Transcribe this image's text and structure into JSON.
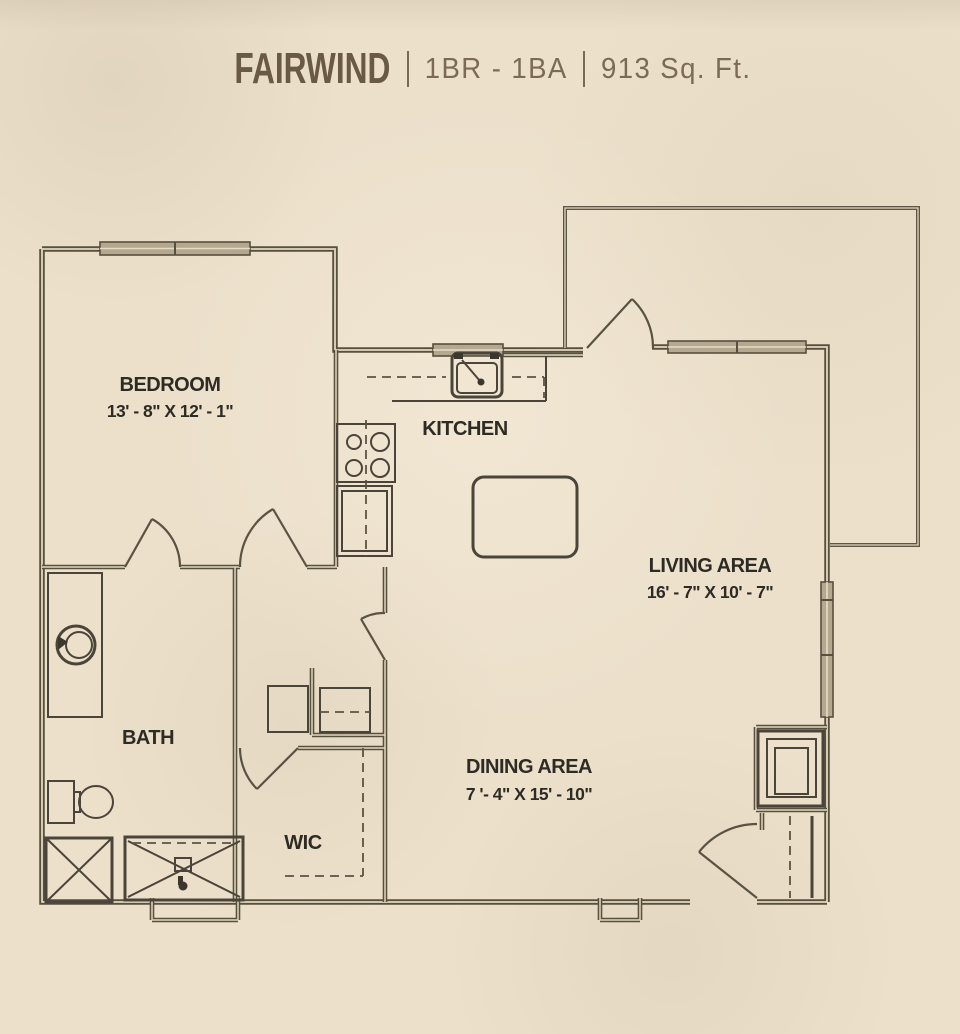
{
  "header": {
    "plan_name": "FAIRWIND",
    "configuration": "1BR - 1BA",
    "area": "913 Sq. Ft."
  },
  "rooms": {
    "bedroom": {
      "label": "BEDROOM",
      "dims": "13' - 8\" X 12' - 1\""
    },
    "kitchen": {
      "label": "KITCHEN"
    },
    "living": {
      "label": "LIVING AREA",
      "dims": "16' - 7\" X 10' - 7\""
    },
    "bath": {
      "label": "BATH"
    },
    "wic": {
      "label": "WIC"
    },
    "dining": {
      "label": "DINING AREA",
      "dims": "7 '- 4\" X 15' - 10\""
    }
  },
  "colors": {
    "background": "#ece0cb",
    "wall": "#57503f",
    "window_fill": "#b4a890",
    "title": "#6a5a45",
    "subtitle": "#7c6b54",
    "label_text": "#2e2b25"
  }
}
